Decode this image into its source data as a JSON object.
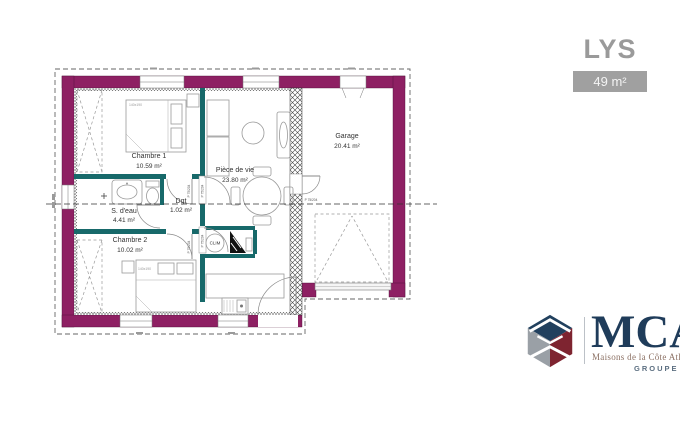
{
  "title": {
    "model": "LYS",
    "area": "49 m²"
  },
  "floor_plan": {
    "rooms": [
      {
        "name": "Chambre 1",
        "area": "10.59 m²"
      },
      {
        "name": "S. d'eau",
        "area": "4.41 m²"
      },
      {
        "name": "Dgt",
        "area": "1.02 m²"
      },
      {
        "name": "Chambre 2",
        "area": "10.02 m²"
      },
      {
        "name": "Pièce de vie",
        "area": "23.80 m²"
      },
      {
        "name": "Garage",
        "area": "20.41 m²"
      }
    ],
    "labels": {
      "clim": "CLIM",
      "door": "P 75/204",
      "bed": "140x190"
    },
    "colors": {
      "exterior_wall": "#8e2063",
      "interior_wall": "#17696a"
    }
  },
  "brand": {
    "name": "MCA",
    "tagline": "Maisons de la Côte Atlantique",
    "group": "GROUPE HEXAŌM"
  }
}
